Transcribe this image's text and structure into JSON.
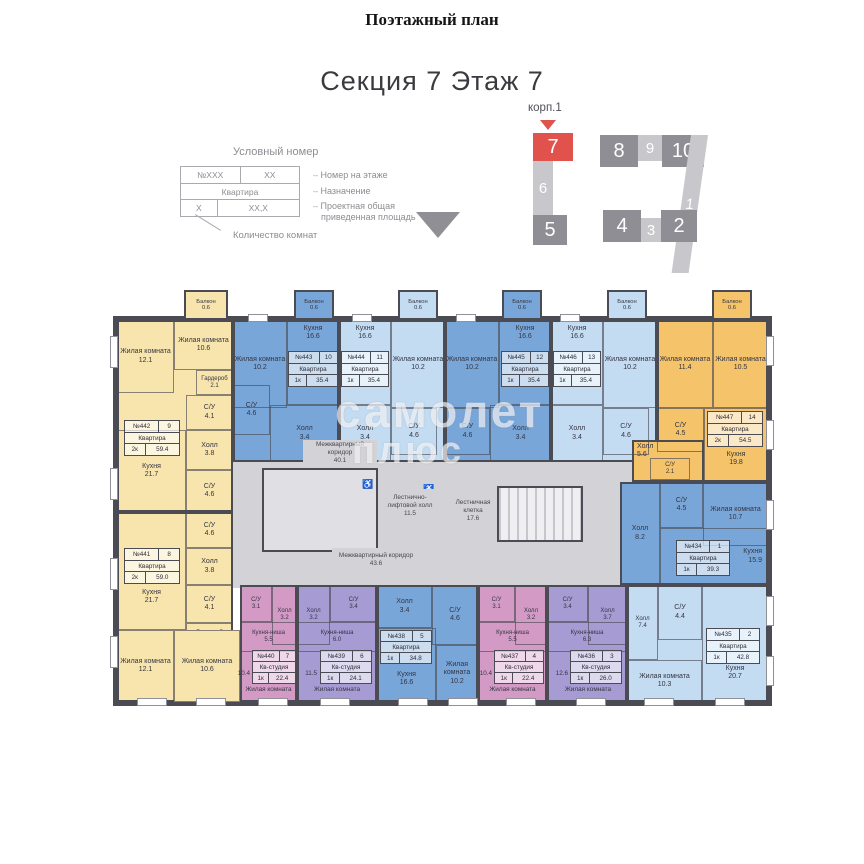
{
  "page": {
    "title": "Поэтажный план",
    "section_title": "Секция 7 Этаж 7"
  },
  "legend": {
    "title": "Условный номер",
    "cell_num": "№XXX",
    "cell_pos": "XX",
    "cell_type": "Квартира",
    "cell_rooms": "X",
    "cell_area": "XX,X",
    "note_number": "Номер на этаже",
    "note_purpose": "Назначение",
    "note_area_1": "Проектная общая",
    "note_area_2": "приведенная площадь",
    "note_rooms": "Количество комнат"
  },
  "section_diagram": {
    "label": "корп.1",
    "sections": [
      {
        "n": "7"
      },
      {
        "n": "6"
      },
      {
        "n": "5"
      },
      {
        "n": "8"
      },
      {
        "n": "9"
      },
      {
        "n": "10"
      },
      {
        "n": "1"
      },
      {
        "n": "4"
      },
      {
        "n": "3"
      },
      {
        "n": "2"
      }
    ]
  },
  "colors": {
    "highlight_red": "#e2524d",
    "yellow": "#f8e5ad",
    "orange": "#f4c36a",
    "blue": "#79a6d8",
    "light_blue": "#c3dcf2",
    "pink": "#d39ac6",
    "purple": "#a69bd3",
    "common_gray": "#d3d3d7"
  },
  "plan": {
    "watermark_line1": "самолет",
    "watermark_line2": "плюс",
    "common": {
      "corridor1_name": "Межквартирный коридор",
      "corridor1_area": "40.1",
      "corridor2_name": "Межквартирный коридор",
      "corridor2_area": "43.6",
      "lift_hall_name": "Лестнично-лифтовой холл",
      "lift_hall_area": "11.5",
      "stairs_name": "Лестничная клетка",
      "stairs_area": "17.6"
    },
    "apartments": [
      {
        "num": "№442",
        "pos": "9",
        "type": "Квартира",
        "rooms_label": "2к",
        "total": "59.4",
        "balcony": {
          "name": "Балкон",
          "area": "0.6"
        },
        "rooms": [
          {
            "name": "Жилая комната",
            "area": "12.1"
          },
          {
            "name": "Жилая комната",
            "area": "10.6"
          },
          {
            "name": "Гардероб",
            "area": "2.1"
          },
          {
            "name": "С/У",
            "area": "4.1"
          },
          {
            "name": "Кухня",
            "area": "21.7"
          },
          {
            "name": "Холл",
            "area": "3.8"
          },
          {
            "name": "С/У",
            "area": "4.6"
          }
        ]
      },
      {
        "num": "№443",
        "pos": "10",
        "type": "Квартира",
        "rooms_label": "1к",
        "total": "35.4",
        "balcony": {
          "name": "Балкон",
          "area": "0.6"
        },
        "rooms": [
          {
            "name": "Жилая комната",
            "area": "10.2"
          },
          {
            "name": "Кухня",
            "area": "16.6"
          },
          {
            "name": "С/У",
            "area": "4.6"
          },
          {
            "name": "Холл",
            "area": "3.4"
          }
        ]
      },
      {
        "num": "№444",
        "pos": "11",
        "type": "Квартира",
        "rooms_label": "1к",
        "total": "35.4",
        "balcony": {
          "name": "Балкон",
          "area": "0.6"
        },
        "rooms": [
          {
            "name": "Кухня",
            "area": "16.6"
          },
          {
            "name": "Жилая комната",
            "area": "10.2"
          },
          {
            "name": "С/У",
            "area": "4.6"
          },
          {
            "name": "Холл",
            "area": "3.4"
          }
        ]
      },
      {
        "num": "№445",
        "pos": "12",
        "type": "Квартира",
        "rooms_label": "1к",
        "total": "35.4",
        "balcony": {
          "name": "Балкон",
          "area": "0.6"
        },
        "rooms": [
          {
            "name": "Жилая комната",
            "area": "10.2"
          },
          {
            "name": "Кухня",
            "area": "16.6"
          },
          {
            "name": "С/У",
            "area": "4.6"
          },
          {
            "name": "Холл",
            "area": "3.4"
          }
        ]
      },
      {
        "num": "№446",
        "pos": "13",
        "type": "Квартира",
        "rooms_label": "1к",
        "total": "35.4",
        "balcony": {
          "name": "Балкон",
          "area": "0.6"
        },
        "rooms": [
          {
            "name": "Кухня",
            "area": "16.6"
          },
          {
            "name": "Жилая комната",
            "area": "10.2"
          },
          {
            "name": "С/У",
            "area": "4.6"
          },
          {
            "name": "Холл",
            "area": "3.4"
          }
        ]
      },
      {
        "num": "№447",
        "pos": "14",
        "type": "Квартира",
        "rooms_label": "2к",
        "total": "54.5",
        "balcony": {
          "name": "Балкон",
          "area": "0.6"
        },
        "rooms": [
          {
            "name": "Жилая комната",
            "area": "11.4"
          },
          {
            "name": "Жилая комната",
            "area": "10.5"
          },
          {
            "name": "С/У",
            "area": "4.5"
          },
          {
            "name": "Кухня",
            "area": "19.8"
          },
          {
            "name": "Холл",
            "area": "5.6"
          },
          {
            "name": "С/У",
            "area": "2.1"
          }
        ]
      },
      {
        "num": "№434",
        "pos": "1",
        "type": "Квартира",
        "rooms_label": "1к",
        "total": "39.3",
        "rooms": [
          {
            "name": "Холл",
            "area": "8.2"
          },
          {
            "name": "С/У",
            "area": "4.5"
          },
          {
            "name": "Жилая комната",
            "area": "10.7"
          },
          {
            "name": "Кухня",
            "area": "15.9"
          }
        ]
      },
      {
        "num": "№435",
        "pos": "2",
        "type": "Квартира",
        "rooms_label": "1к",
        "total": "42.8",
        "rooms": [
          {
            "name": "Холл",
            "area": "7.4"
          },
          {
            "name": "С/У",
            "area": "4.4"
          },
          {
            "name": "Кухня",
            "area": "20.7"
          },
          {
            "name": "Жилая комната",
            "area": "10.3"
          }
        ]
      },
      {
        "num": "№441",
        "pos": "8",
        "type": "Квартира",
        "rooms_label": "2к",
        "total": "59.0",
        "rooms": [
          {
            "name": "С/У",
            "area": "4.6"
          },
          {
            "name": "Холл",
            "area": "3.8"
          },
          {
            "name": "Кухня",
            "area": "21.7"
          },
          {
            "name": "С/У",
            "area": "4.1"
          },
          {
            "name": "Гардероб",
            "area": "2.1"
          },
          {
            "name": "Жилая комната",
            "area": "12.1"
          },
          {
            "name": "Жилая комната",
            "area": "10.6"
          }
        ]
      },
      {
        "num": "№440",
        "pos": "7",
        "type": "Кв-студия",
        "rooms_label": "1к",
        "total": "22.4",
        "living_name": "Жилая комната",
        "living_area": "10.4",
        "rooms": [
          {
            "name": "С/У",
            "area": "3.1"
          },
          {
            "name": "Холл",
            "area": "3.2"
          },
          {
            "name": "Кухня-ниша",
            "area": "5.5"
          }
        ]
      },
      {
        "num": "№439",
        "pos": "6",
        "type": "Кв-студия",
        "rooms_label": "1к",
        "total": "24.1",
        "living_name": "Жилая комната",
        "living_area": "11.5",
        "rooms": [
          {
            "name": "Холл",
            "area": "3.2"
          },
          {
            "name": "С/У",
            "area": "3.4"
          },
          {
            "name": "Кухня-ниша",
            "area": "6.0"
          }
        ]
      },
      {
        "num": "№438",
        "pos": "5",
        "type": "Квартира",
        "rooms_label": "1к",
        "total": "34.8",
        "rooms": [
          {
            "name": "Холл",
            "area": "3.4"
          },
          {
            "name": "С/У",
            "area": "4.6"
          },
          {
            "name": "Кухня",
            "area": "16.6"
          },
          {
            "name": "Жилая комната",
            "area": "10.2"
          }
        ]
      },
      {
        "num": "№437",
        "pos": "4",
        "type": "Кв-студия",
        "rooms_label": "1к",
        "total": "22.4",
        "living_name": "Жилая комната",
        "living_area": "10.4",
        "rooms": [
          {
            "name": "С/У",
            "area": "3.1"
          },
          {
            "name": "Холл",
            "area": "3.2"
          },
          {
            "name": "Кухня-ниша",
            "area": "5.5"
          }
        ]
      },
      {
        "num": "№436",
        "pos": "3",
        "type": "Кв-студия",
        "rooms_label": "1к",
        "total": "26.0",
        "living_name": "Жилая комната",
        "living_area": "12.6",
        "rooms": [
          {
            "name": "С/У",
            "area": "3.4"
          },
          {
            "name": "Холл",
            "area": "3.7"
          },
          {
            "name": "Кухня-ниша",
            "area": "6.3"
          }
        ]
      }
    ]
  }
}
